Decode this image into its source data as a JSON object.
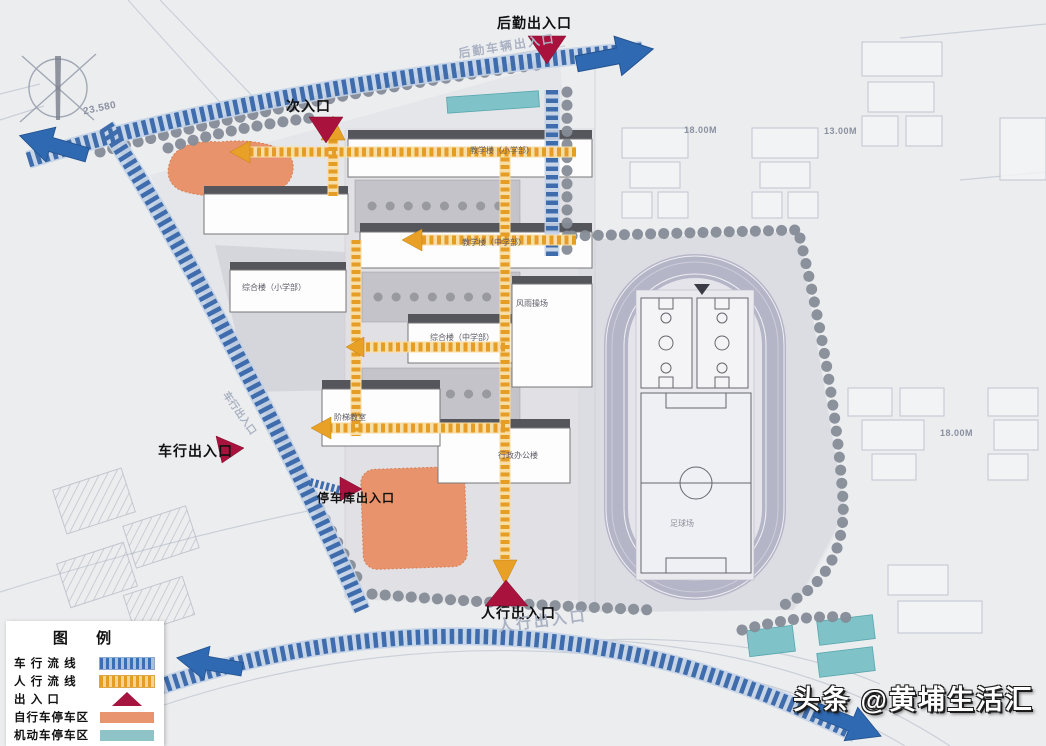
{
  "legend": {
    "title": "图  例",
    "items": [
      {
        "label": "车 行 流 线",
        "type": "dashed",
        "color": "#3a6fb5"
      },
      {
        "label": "人 行 流 线",
        "type": "dashed",
        "color": "#e59d26"
      },
      {
        "label": "出  入  口",
        "type": "triangle",
        "color": "#a5153f"
      },
      {
        "label": "自行车停车区",
        "type": "solid",
        "color": "#e8946e"
      },
      {
        "label": "机动车停车区",
        "type": "solid",
        "color": "#8ec4c8"
      }
    ]
  },
  "entrances": {
    "logistics": "后勤出入口",
    "secondary": "次入口",
    "vehicle": "车行出入口",
    "garage": "停车库出入口",
    "pedestrian": "人行出入口"
  },
  "road_text": {
    "logistics_road": "后勤车辆出入口",
    "pedestrian_road": "人行出入口",
    "vehicle_road": "车行出入口"
  },
  "buildings": {
    "teaching_primary": "教学楼（小学部）",
    "teaching_middle": "教学楼（中学部）",
    "complex_primary": "综合楼（小学部）",
    "complex_middle": "综合楼（中学部）",
    "admin": "行政办公楼",
    "lecture": "阶梯教室",
    "gym": "风雨操场",
    "soccer": "足球场"
  },
  "dimensions": {
    "gap_top_1": "18.00M",
    "gap_top_2": "13.00M",
    "gap_right": "18.00M",
    "road_elevation": "23.580"
  },
  "watermark": "头条 @黄埔生活汇",
  "colors": {
    "vehicle_flow": "#3e6cad",
    "pedestrian_flow": "#e69d26",
    "entrance": "#a8123d",
    "bike_parking": "#e8936c",
    "car_parking": "#7fc3c9",
    "track": "#b5b5c8"
  }
}
